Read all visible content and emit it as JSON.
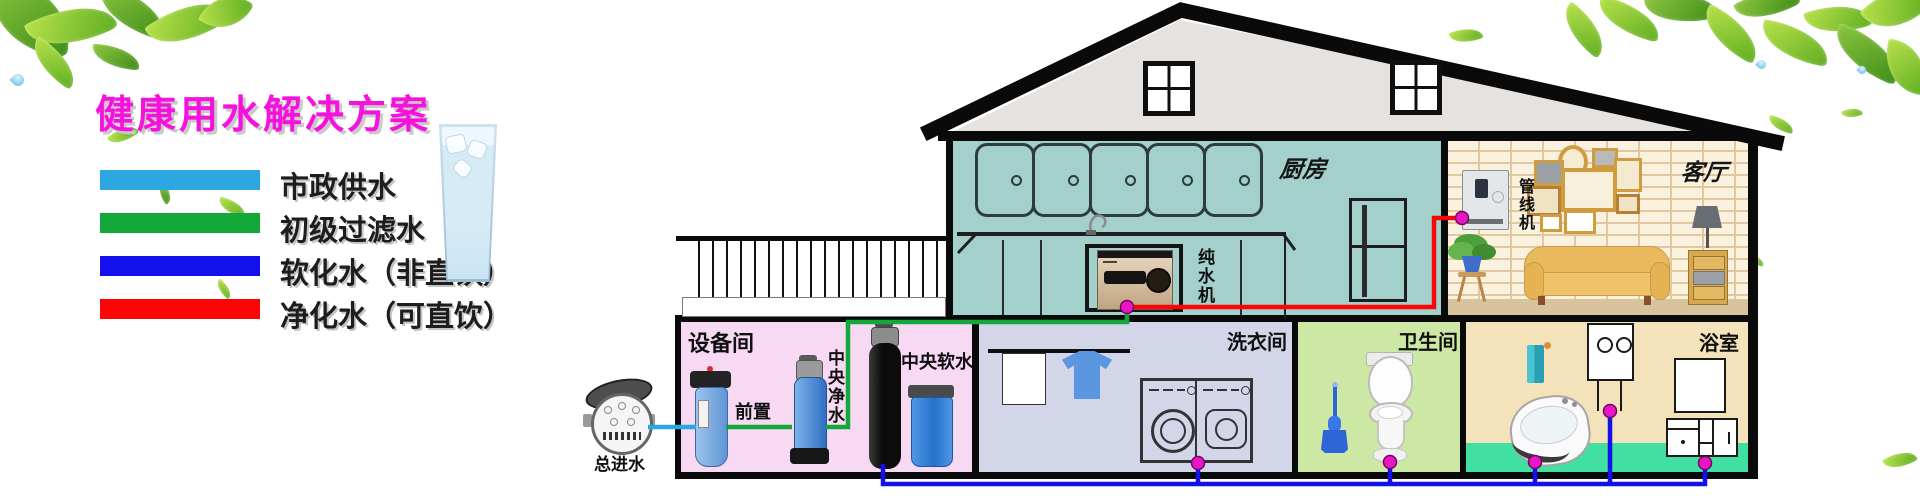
{
  "title": {
    "text": "健康用水解决方案",
    "color": "#f711dd"
  },
  "legend": {
    "items": [
      {
        "key": "municipal",
        "label": "市政供水",
        "color": "#2ba7e2"
      },
      {
        "key": "filtered",
        "label": "初级过滤水",
        "color": "#14a83b"
      },
      {
        "key": "softened",
        "label": "软化水（非直饮）",
        "color": "#1410ec"
      },
      {
        "key": "purified",
        "label": "净化水（可直饮）",
        "color": "#fb0606"
      }
    ]
  },
  "pipe_joint_color": "#e816c6",
  "rooms": {
    "kitchen": {
      "label": "厨房",
      "color": "#a3d0ca"
    },
    "living": {
      "label": "客厅",
      "color": "#faf2df"
    },
    "equipment": {
      "label": "设备间",
      "color": "#f7d9f3"
    },
    "laundry": {
      "label": "洗衣间",
      "color": "#d3d5e9"
    },
    "toilet": {
      "label": "卫生间",
      "color": "#cde7a5"
    },
    "bath": {
      "label": "浴室",
      "color": "#f3e2ba"
    }
  },
  "devices": {
    "main_inlet": "总进水",
    "prefilter": "前置",
    "central_purifier": "中央净水",
    "central_softener": "中央软水",
    "pure_water_machine": "纯水机",
    "pipeline_machine": "管线机"
  }
}
